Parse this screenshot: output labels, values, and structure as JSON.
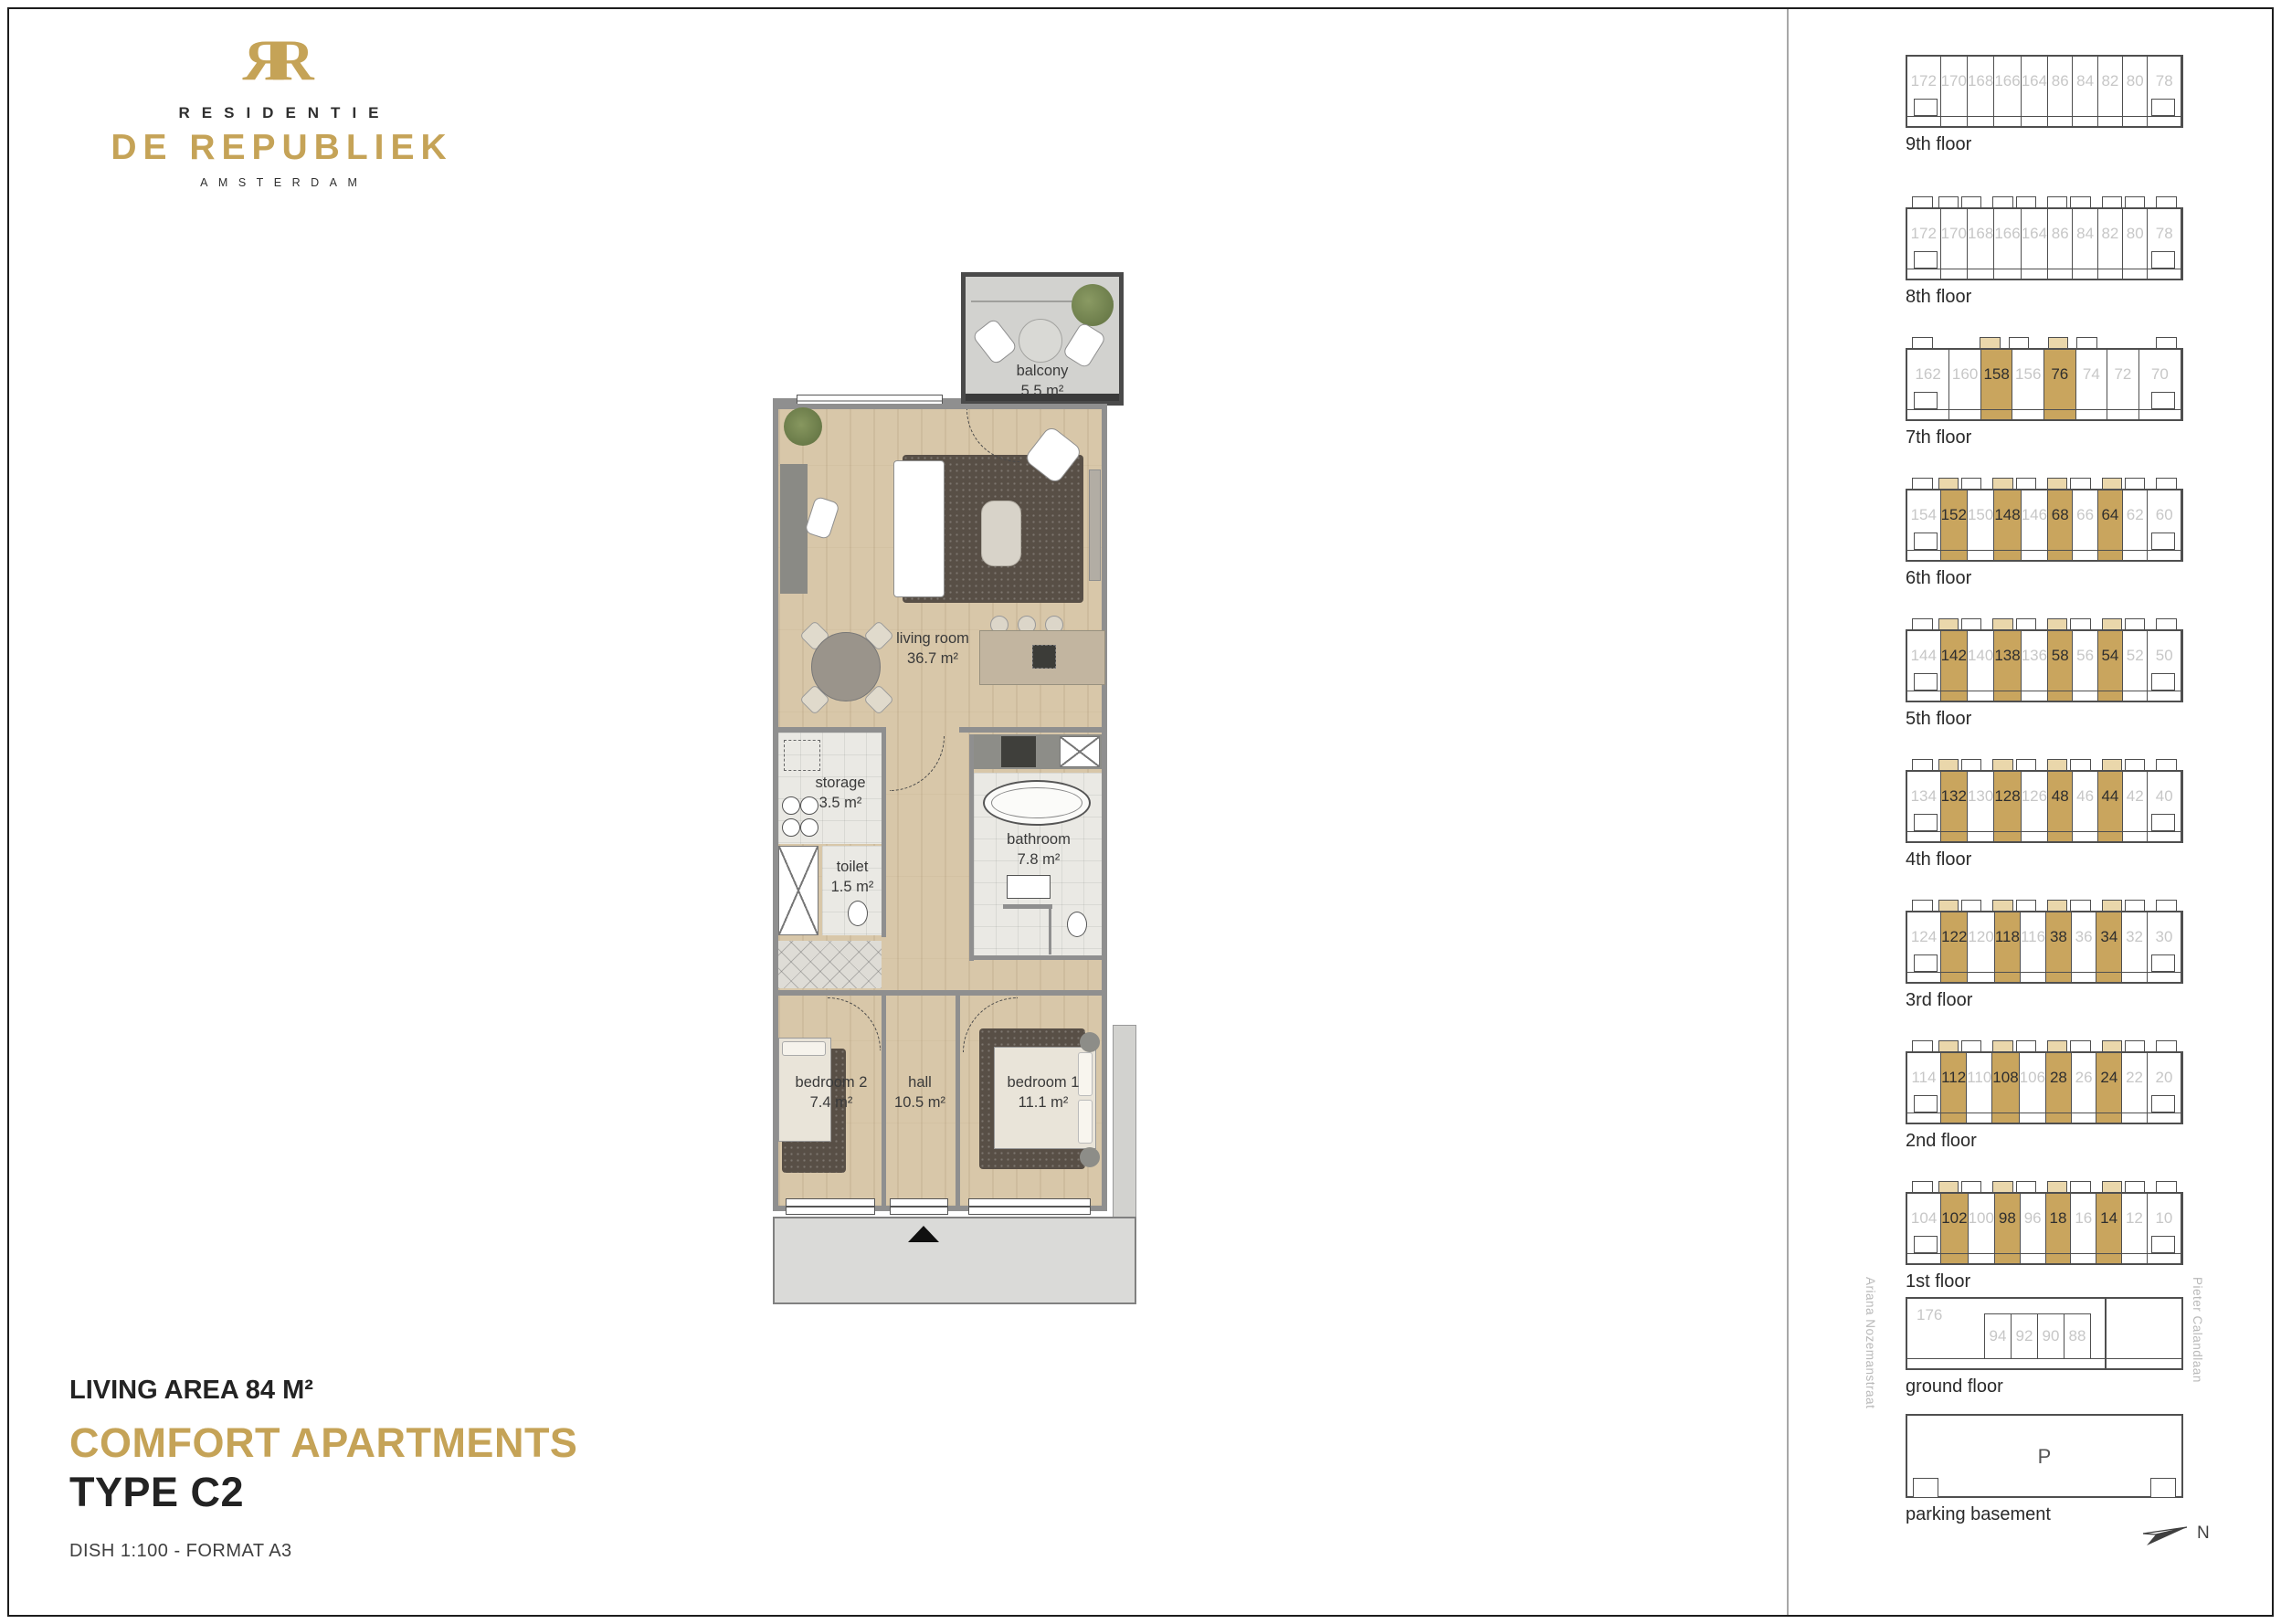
{
  "page": {
    "brand": {
      "monogram_left": "R",
      "monogram_right": "R",
      "residentie": "RESIDENTIE",
      "name": "DE REPUBLIEK",
      "city": "AMSTERDAM"
    },
    "title_block": {
      "living_area": "LIVING AREA 84 M²",
      "headline": "COMFORT APARTMENTS",
      "type": "TYPE C2",
      "note": "DISH 1:100  -  FORMAT A3"
    }
  },
  "floorplan": {
    "rooms": {
      "balcony": {
        "name": "balcony",
        "area": "5.5 m²"
      },
      "living": {
        "name": "living room",
        "area": "36.7 m²"
      },
      "storage": {
        "name": "storage",
        "area": "3.5 m²"
      },
      "toilet": {
        "name": "toilet",
        "area": "1.5 m²"
      },
      "bathroom": {
        "name": "bathroom",
        "area": "7.8 m²"
      },
      "bedroom2": {
        "name": "bedroom 2",
        "area": "7.4 m²"
      },
      "hall": {
        "name": "hall",
        "area": "10.5 m²"
      },
      "bedroom1": {
        "name": "bedroom 1",
        "area": "11.1 m²"
      }
    }
  },
  "sidebar": {
    "floors": [
      {
        "label": "9th floor",
        "bumps": false,
        "units": [
          {
            "n": "172",
            "h": false
          },
          {
            "n": "170",
            "h": false
          },
          {
            "n": "168",
            "h": false
          },
          {
            "n": "166",
            "h": false
          },
          {
            "n": "164",
            "h": false
          },
          {
            "n": "86",
            "h": false
          },
          {
            "n": "84",
            "h": false
          },
          {
            "n": "82",
            "h": false
          },
          {
            "n": "80",
            "h": false
          },
          {
            "n": "78",
            "h": false
          }
        ]
      },
      {
        "label": "8th floor",
        "bumps": true,
        "units": [
          {
            "n": "172",
            "h": false
          },
          {
            "n": "170",
            "h": false
          },
          {
            "n": "168",
            "h": false
          },
          {
            "n": "166",
            "h": false
          },
          {
            "n": "164",
            "h": false
          },
          {
            "n": "86",
            "h": false
          },
          {
            "n": "84",
            "h": false
          },
          {
            "n": "82",
            "h": false
          },
          {
            "n": "80",
            "h": false
          },
          {
            "n": "78",
            "h": false
          }
        ]
      },
      {
        "label": "7th floor",
        "bumps": true,
        "units": [
          {
            "n": "162",
            "h": false
          },
          {
            "n": "160",
            "h": false
          },
          {
            "n": "158",
            "h": true
          },
          {
            "n": "156",
            "h": false
          },
          {
            "n": "76",
            "h": true
          },
          {
            "n": "74",
            "h": false
          },
          {
            "n": "72",
            "h": false
          },
          {
            "n": "70",
            "h": false
          }
        ]
      },
      {
        "label": "6th floor",
        "bumps": true,
        "units": [
          {
            "n": "154",
            "h": false
          },
          {
            "n": "152",
            "h": true
          },
          {
            "n": "150",
            "h": false
          },
          {
            "n": "148",
            "h": true
          },
          {
            "n": "146",
            "h": false
          },
          {
            "n": "68",
            "h": true
          },
          {
            "n": "66",
            "h": false
          },
          {
            "n": "64",
            "h": true
          },
          {
            "n": "62",
            "h": false
          },
          {
            "n": "60",
            "h": false
          }
        ]
      },
      {
        "label": "5th floor",
        "bumps": true,
        "units": [
          {
            "n": "144",
            "h": false
          },
          {
            "n": "142",
            "h": true
          },
          {
            "n": "140",
            "h": false
          },
          {
            "n": "138",
            "h": true
          },
          {
            "n": "136",
            "h": false
          },
          {
            "n": "58",
            "h": true
          },
          {
            "n": "56",
            "h": false
          },
          {
            "n": "54",
            "h": true
          },
          {
            "n": "52",
            "h": false
          },
          {
            "n": "50",
            "h": false
          }
        ]
      },
      {
        "label": "4th floor",
        "bumps": true,
        "units": [
          {
            "n": "134",
            "h": false
          },
          {
            "n": "132",
            "h": true
          },
          {
            "n": "130",
            "h": false
          },
          {
            "n": "128",
            "h": true
          },
          {
            "n": "126",
            "h": false
          },
          {
            "n": "48",
            "h": true
          },
          {
            "n": "46",
            "h": false
          },
          {
            "n": "44",
            "h": true
          },
          {
            "n": "42",
            "h": false
          },
          {
            "n": "40",
            "h": false
          }
        ]
      },
      {
        "label": "3rd floor",
        "bumps": true,
        "units": [
          {
            "n": "124",
            "h": false
          },
          {
            "n": "122",
            "h": true
          },
          {
            "n": "120",
            "h": false
          },
          {
            "n": "118",
            "h": true
          },
          {
            "n": "116",
            "h": false
          },
          {
            "n": "38",
            "h": true
          },
          {
            "n": "36",
            "h": false
          },
          {
            "n": "34",
            "h": true
          },
          {
            "n": "32",
            "h": false
          },
          {
            "n": "30",
            "h": false
          }
        ]
      },
      {
        "label": "2nd floor",
        "bumps": true,
        "units": [
          {
            "n": "114",
            "h": false
          },
          {
            "n": "112",
            "h": true
          },
          {
            "n": "110",
            "h": false
          },
          {
            "n": "108",
            "h": true
          },
          {
            "n": "106",
            "h": false
          },
          {
            "n": "28",
            "h": true
          },
          {
            "n": "26",
            "h": false
          },
          {
            "n": "24",
            "h": true
          },
          {
            "n": "22",
            "h": false
          },
          {
            "n": "20",
            "h": false
          }
        ]
      },
      {
        "label": "1st floor",
        "bumps": true,
        "units": [
          {
            "n": "104",
            "h": false
          },
          {
            "n": "102",
            "h": true
          },
          {
            "n": "100",
            "h": false
          },
          {
            "n": "98",
            "h": true
          },
          {
            "n": "96",
            "h": false
          },
          {
            "n": "18",
            "h": true
          },
          {
            "n": "16",
            "h": false
          },
          {
            "n": "14",
            "h": true
          },
          {
            "n": "12",
            "h": false
          },
          {
            "n": "10",
            "h": false
          }
        ]
      }
    ],
    "ground": {
      "label": "ground floor",
      "corner_unit": "176",
      "units": [
        "94",
        "92",
        "90",
        "88"
      ],
      "street_left": "Ariana Nozemanstraat",
      "street_right": "Pieter Calandlaan"
    },
    "parking": {
      "label": "parking basement",
      "symbol": "P"
    },
    "compass_label": "N"
  },
  "colors": {
    "gold": "#c5a357",
    "unit_highlight": "#c9a55e",
    "unit_highlight_tab": "#ead7ab",
    "unit_number_gray": "#c7c7c7",
    "outline": "#4f4f4f"
  }
}
